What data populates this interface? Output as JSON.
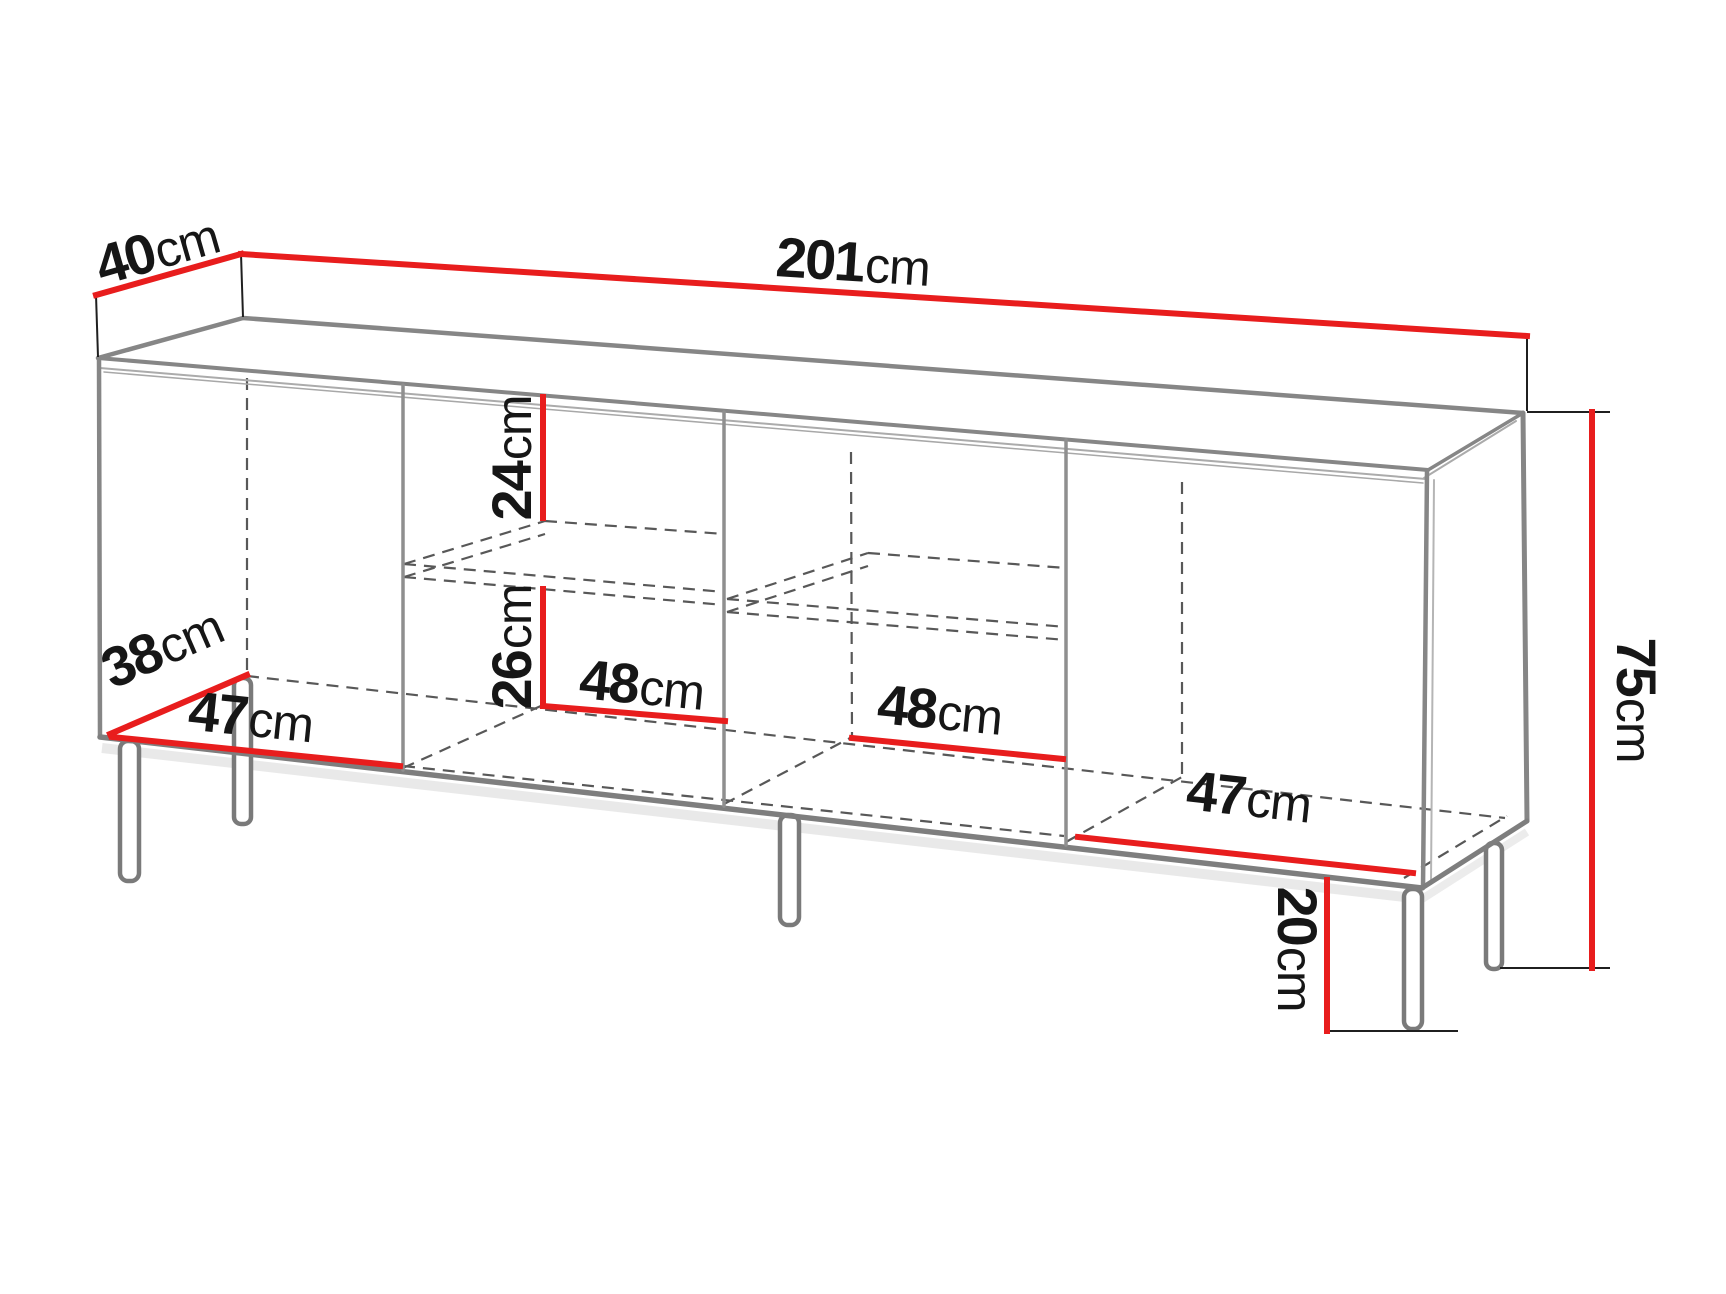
{
  "diagram": {
    "kind": "furniture dimension drawing",
    "subject": "sideboard with four compartments, two shelves and metal legs",
    "colors": {
      "background": "#ffffff",
      "dimension_line": "#e81d1d",
      "edge_gray": "#868686",
      "edge_dark_gray": "#7a7a7a",
      "hidden_dashed": "#585858",
      "extension_black": "#1f1f1f",
      "label_text": "#161616"
    },
    "dims": {
      "top_depth": {
        "value": "40",
        "unit": "cm"
      },
      "total_width": {
        "value": "201",
        "unit": "cm"
      },
      "total_height": {
        "value": "75",
        "unit": "cm"
      },
      "interior_depth": {
        "value": "38",
        "unit": "cm"
      },
      "comp1_width": {
        "value": "47",
        "unit": "cm"
      },
      "above_shelf_height": {
        "value": "24",
        "unit": "cm"
      },
      "below_shelf_height": {
        "value": "26",
        "unit": "cm"
      },
      "comp2_width": {
        "value": "48",
        "unit": "cm"
      },
      "comp3_width": {
        "value": "48",
        "unit": "cm"
      },
      "comp4_width": {
        "value": "47",
        "unit": "cm"
      },
      "leg_height": {
        "value": "20",
        "unit": "cm"
      }
    }
  }
}
